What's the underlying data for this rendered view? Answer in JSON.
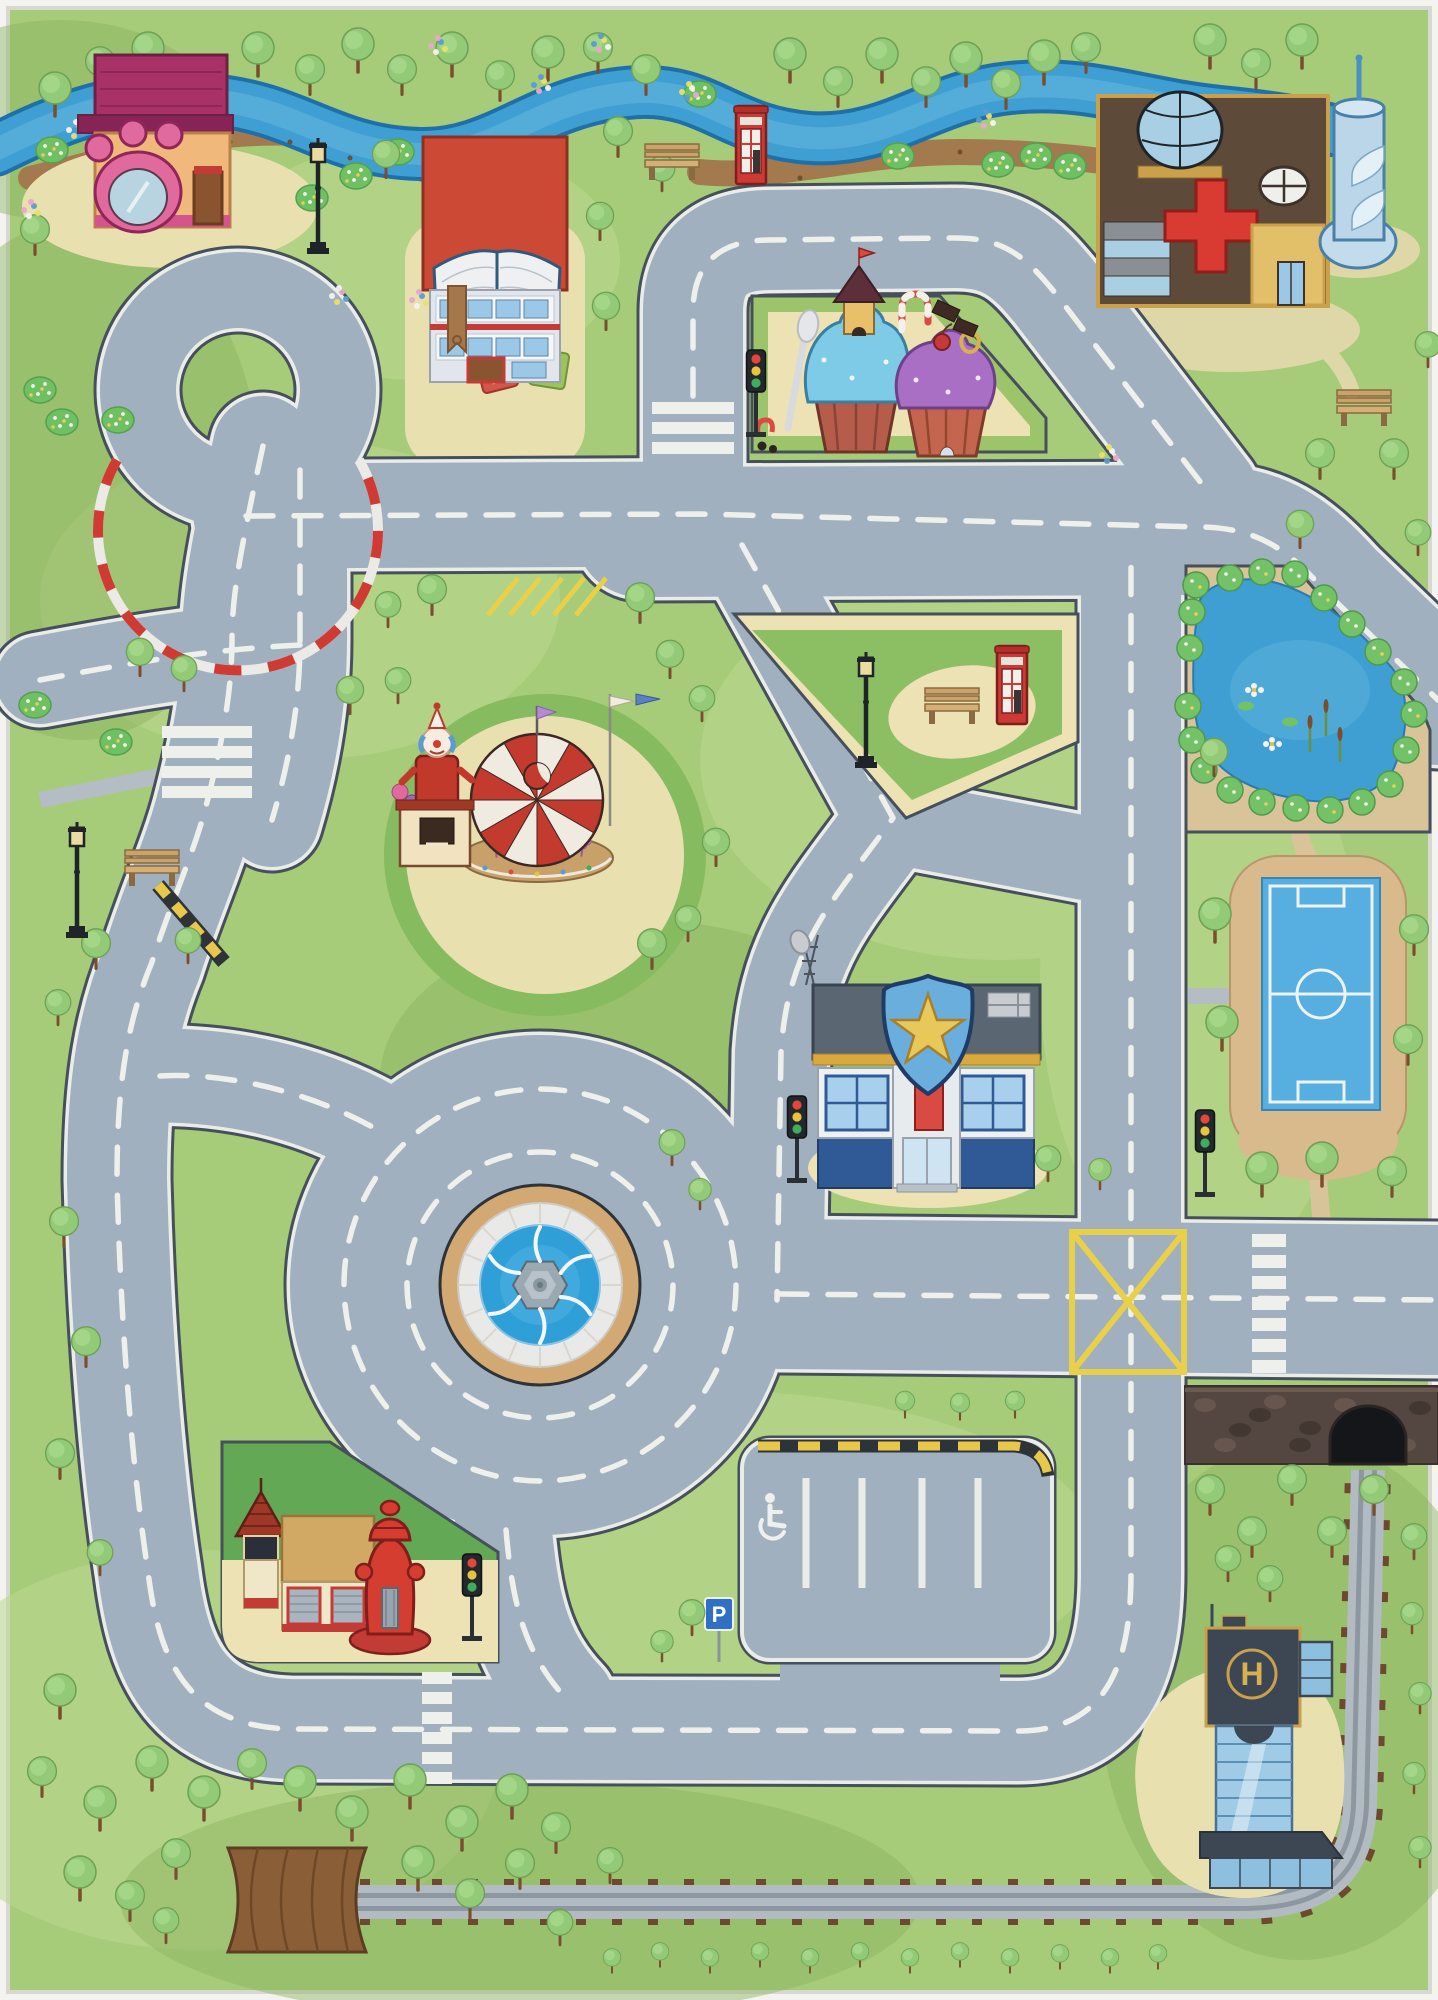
{
  "title": "Children's city road play mat rug - top view",
  "labels": {
    "parking_p": "P",
    "helipad_h": "H"
  },
  "library_letters": [
    "a",
    "c",
    "b",
    "d"
  ],
  "landmarks": [
    "pet-shop",
    "library-book-building",
    "candy-cupcake-houses",
    "hospital",
    "water-tower",
    "river",
    "race-loop",
    "carousel",
    "clown-booth",
    "park-triangle-with-bench-and-phone-box",
    "police-station",
    "pond",
    "soccer-field",
    "fountain-roundabout",
    "yellow-box-junction",
    "parking-lot-with-disabled-bay",
    "fire-station-with-hydrant",
    "helipad-office-building",
    "railway-with-tunnels",
    "wooden-bridge"
  ],
  "palette": {
    "grass": "#a6cb79",
    "grass_light": "#bcd98f",
    "grass_dark": "#8ab45f",
    "road": "#a0b0be",
    "road_edge": "#46505a",
    "line_white": "#eef0ec",
    "path_cream": "#ece2b4",
    "river": "#3f9fd2",
    "river_edge": "#1f70a8",
    "dirt": "#a3794e",
    "tree": "#93ca77",
    "trunk": "#7a4e2c",
    "pond": "#3f9fd2",
    "pitch": "#57aee0",
    "sand": "#d9ba8c",
    "curb_red": "#cf3b32",
    "hazard_yellow": "#e8c84a",
    "junction_yellow": "#e8d04a",
    "roof_red": "#cc4a35",
    "magenta": "#a83268",
    "police_blue": "#4a7fc1",
    "badge_gold": "#e8c85a",
    "glass": "#9cc8e8",
    "hydrant_red": "#d43d30",
    "wood": "#8a5f38",
    "track": "#b3bbc2",
    "sleeper": "#6b4a2e",
    "stone": "#544640"
  },
  "traffic_light_colors": [
    "#e0483e",
    "#e8c43c",
    "#3fae5a"
  ],
  "scene": {
    "traffic_lights": [
      [
        756,
        350
      ],
      [
        797,
        1096
      ],
      [
        1205,
        1110
      ],
      [
        472,
        1554
      ]
    ],
    "benches": [
      [
        672,
        160
      ],
      [
        1364,
        406
      ],
      [
        952,
        704
      ],
      [
        152,
        866
      ]
    ],
    "lamps": [
      [
        318,
        148
      ],
      [
        77,
        832
      ],
      [
        866,
        662
      ]
    ],
    "phone_boxes": [
      [
        736,
        106
      ],
      [
        997,
        646
      ]
    ],
    "trees": [
      [
        55,
        100,
        1
      ],
      [
        100,
        72,
        0.9
      ],
      [
        148,
        60,
        1
      ],
      [
        200,
        86,
        0.9
      ],
      [
        258,
        60,
        1
      ],
      [
        310,
        80,
        0.9
      ],
      [
        358,
        56,
        1
      ],
      [
        402,
        80,
        0.9
      ],
      [
        452,
        60,
        1
      ],
      [
        500,
        86,
        0.9
      ],
      [
        548,
        64,
        1
      ],
      [
        598,
        58,
        0.9
      ],
      [
        646,
        80,
        0.9
      ],
      [
        790,
        66,
        1
      ],
      [
        838,
        92,
        0.9
      ],
      [
        882,
        66,
        1
      ],
      [
        926,
        92,
        0.9
      ],
      [
        966,
        70,
        1
      ],
      [
        1006,
        94,
        0.9
      ],
      [
        1044,
        68,
        1
      ],
      [
        1086,
        58,
        0.9
      ],
      [
        1210,
        52,
        1
      ],
      [
        1256,
        74,
        0.9
      ],
      [
        1302,
        52,
        1
      ],
      [
        35,
        240,
        0.9
      ],
      [
        618,
        142,
        0.9
      ],
      [
        600,
        226,
        0.85
      ],
      [
        606,
        316,
        0.85
      ],
      [
        662,
        178,
        0.8
      ],
      [
        386,
        164,
        0.85
      ],
      [
        432,
        600,
        0.9
      ],
      [
        388,
        614,
        0.8
      ],
      [
        350,
        700,
        0.85
      ],
      [
        398,
        690,
        0.8
      ],
      [
        640,
        608,
        0.9
      ],
      [
        670,
        664,
        0.85
      ],
      [
        702,
        708,
        0.8
      ],
      [
        716,
        852,
        0.85
      ],
      [
        652,
        954,
        0.9
      ],
      [
        688,
        928,
        0.8
      ],
      [
        140,
        662,
        0.85
      ],
      [
        184,
        678,
        0.8
      ],
      [
        96,
        954,
        0.9
      ],
      [
        188,
        950,
        0.8
      ],
      [
        58,
        1012,
        0.8
      ],
      [
        64,
        1232,
        0.9
      ],
      [
        86,
        1352,
        0.9
      ],
      [
        60,
        1464,
        0.9
      ],
      [
        100,
        1562,
        0.8
      ],
      [
        1320,
        464,
        0.9
      ],
      [
        1394,
        464,
        0.9
      ],
      [
        1428,
        354,
        0.8
      ],
      [
        1300,
        534,
        0.85
      ],
      [
        1418,
        542,
        0.8
      ],
      [
        1214,
        762,
        0.85
      ],
      [
        1215,
        926,
        1
      ],
      [
        1222,
        1034,
        1
      ],
      [
        1414,
        940,
        0.9
      ],
      [
        1408,
        1050,
        0.9
      ],
      [
        1262,
        1180,
        1
      ],
      [
        1322,
        1170,
        1
      ],
      [
        1392,
        1182,
        0.9
      ],
      [
        1210,
        1500,
        0.9
      ],
      [
        1252,
        1542,
        0.9
      ],
      [
        1292,
        1490,
        0.9
      ],
      [
        1332,
        1542,
        0.9
      ],
      [
        1374,
        1500,
        0.9
      ],
      [
        1414,
        1546,
        0.8
      ],
      [
        1228,
        1568,
        0.8
      ],
      [
        1270,
        1588,
        0.8
      ],
      [
        1412,
        1622,
        0.7
      ],
      [
        1420,
        1702,
        0.7
      ],
      [
        1414,
        1782,
        0.7
      ],
      [
        1420,
        1856,
        0.7
      ],
      [
        692,
        1622,
        0.8
      ],
      [
        662,
        1650,
        0.7
      ],
      [
        60,
        1702,
        1
      ],
      [
        42,
        1782,
        0.9
      ],
      [
        100,
        1814,
        1
      ],
      [
        152,
        1774,
        1
      ],
      [
        204,
        1804,
        1
      ],
      [
        252,
        1774,
        0.9
      ],
      [
        300,
        1794,
        1
      ],
      [
        352,
        1824,
        1
      ],
      [
        410,
        1792,
        1
      ],
      [
        462,
        1834,
        1
      ],
      [
        512,
        1802,
        1
      ],
      [
        556,
        1838,
        0.9
      ],
      [
        80,
        1884,
        1
      ],
      [
        130,
        1906,
        0.9
      ],
      [
        176,
        1864,
        0.9
      ],
      [
        166,
        1930,
        0.8
      ],
      [
        418,
        1874,
        1
      ],
      [
        470,
        1904,
        0.9
      ],
      [
        520,
        1874,
        0.9
      ],
      [
        560,
        1932,
        0.8
      ],
      [
        610,
        1870,
        0.8
      ],
      [
        612,
        1964,
        0.55
      ],
      [
        660,
        1958,
        0.55
      ],
      [
        710,
        1964,
        0.55
      ],
      [
        760,
        1958,
        0.55
      ],
      [
        810,
        1964,
        0.55
      ],
      [
        860,
        1958,
        0.55
      ],
      [
        910,
        1964,
        0.55
      ],
      [
        960,
        1958,
        0.55
      ],
      [
        1010,
        1964,
        0.55
      ],
      [
        1060,
        1960,
        0.55
      ],
      [
        1110,
        1964,
        0.55
      ],
      [
        1158,
        1960,
        0.55
      ],
      [
        905,
        1408,
        0.6
      ],
      [
        960,
        1410,
        0.6
      ],
      [
        1015,
        1408,
        0.6
      ],
      [
        1048,
        1168,
        0.8
      ],
      [
        1100,
        1178,
        0.7
      ],
      [
        672,
        1152,
        0.8
      ],
      [
        700,
        1198,
        0.7
      ]
    ],
    "bushes": [
      [
        52,
        150
      ],
      [
        398,
        152
      ],
      [
        356,
        176
      ],
      [
        312,
        198
      ],
      [
        898,
        156
      ],
      [
        998,
        164
      ],
      [
        1036,
        156
      ],
      [
        1070,
        166
      ],
      [
        700,
        94
      ],
      [
        40,
        390
      ],
      [
        62,
        422
      ],
      [
        35,
        705
      ],
      [
        116,
        742
      ],
      [
        118,
        420
      ]
    ],
    "flowers": [
      [
        437,
        46
      ],
      [
        600,
        44
      ],
      [
        688,
        92
      ],
      [
        338,
        296
      ],
      [
        418,
        300
      ],
      [
        985,
        120
      ],
      [
        1108,
        455
      ],
      [
        75,
        130
      ],
      [
        30,
        210
      ],
      [
        540,
        85
      ]
    ],
    "pond_bushes": [
      [
        1196,
        585
      ],
      [
        1230,
        578
      ],
      [
        1262,
        572
      ],
      [
        1295,
        574
      ],
      [
        1324,
        598
      ],
      [
        1352,
        624
      ],
      [
        1378,
        652
      ],
      [
        1404,
        682
      ],
      [
        1414,
        714
      ],
      [
        1406,
        750
      ],
      [
        1390,
        784
      ],
      [
        1362,
        802
      ],
      [
        1330,
        810
      ],
      [
        1296,
        808
      ],
      [
        1262,
        802
      ],
      [
        1230,
        790
      ],
      [
        1204,
        770
      ],
      [
        1192,
        740
      ],
      [
        1188,
        706
      ],
      [
        1190,
        648
      ],
      [
        1192,
        612
      ]
    ],
    "wall_stones": [
      [
        1205,
        1405
      ],
      [
        1240,
        1430
      ],
      [
        1275,
        1402
      ],
      [
        1310,
        1428
      ],
      [
        1345,
        1405
      ],
      [
        1260,
        1415
      ],
      [
        1225,
        1445
      ],
      [
        1300,
        1445
      ],
      [
        1370,
        1420
      ],
      [
        1420,
        1408
      ],
      [
        1405,
        1445
      ]
    ],
    "dirt_dots": [
      [
        120,
        168
      ],
      [
        170,
        158
      ],
      [
        230,
        142
      ],
      [
        290,
        142
      ],
      [
        350,
        158
      ],
      [
        740,
        176
      ],
      [
        800,
        178
      ],
      [
        900,
        158
      ],
      [
        960,
        152
      ],
      [
        1060,
        160
      ],
      [
        1140,
        168
      ]
    ]
  }
}
